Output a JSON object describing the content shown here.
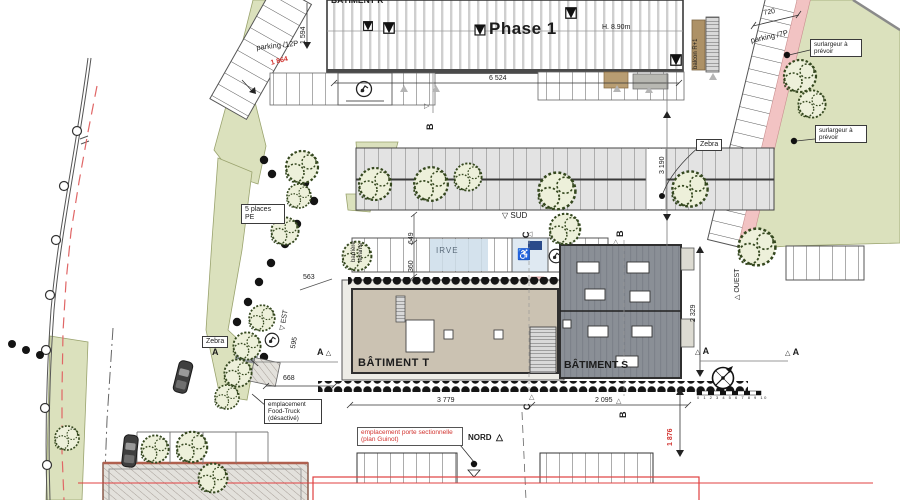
{
  "plan": {
    "buildings": {
      "r": "BÂTIMENT R",
      "phase": "Phase 1",
      "height": "H. 8.90m",
      "t": "BÂTIMENT T",
      "s": "BÂTIMENT S",
      "balcon": "balcon R+1"
    },
    "parking": {
      "nw": "parking /12P",
      "ne": "parking /7P",
      "places_pe": "5 places PE",
      "irve": "IRVE",
      "barriere": "barrière levante",
      "zebra": "Zebra"
    },
    "notes": {
      "surlargeur": "surlargeur à prévoir",
      "food_truck": [
        "emplacement",
        "Food-Truck",
        "(désactivé)"
      ],
      "porte": [
        "emplacement porte sectionnelle",
        "(plan Guinot)"
      ]
    },
    "orientation": {
      "nord": "NORD",
      "sud": "SUD",
      "est": "EST",
      "ouest": "OUEST"
    },
    "sections": {
      "a": "A",
      "b": "B",
      "c": "C"
    },
    "dims": {
      "d1594": "1 594",
      "d1864": "1 864",
      "d6524": "6 524",
      "d720": "720",
      "d3190": "3 190",
      "d649": "649",
      "d360": "360",
      "d563": "563",
      "d595": "595",
      "d668": "668",
      "d3779": "3 779",
      "d2095": "2 095",
      "d2329": "2 329",
      "d1876": "1 876"
    },
    "scale_numbers": "0 1 2 3 4 5 6 7 8 9 10",
    "icons": {
      "triangle_up": "△",
      "triangle_down": "▽",
      "triangle_left": "◁",
      "triangle_right": "▷",
      "wheelchair": "♿"
    },
    "colors": {
      "green": "#dbe1bd",
      "pink": "#f2c3c3",
      "red": "#d23430",
      "building_s": "#8a8f96",
      "building_t": "#cbc2b2"
    }
  }
}
